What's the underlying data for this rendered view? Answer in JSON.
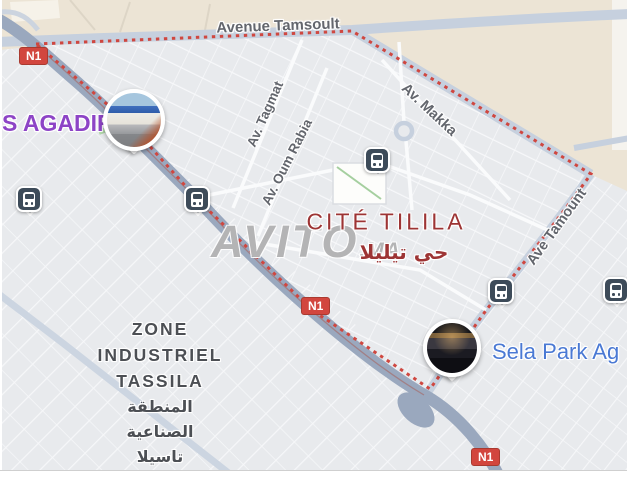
{
  "labels": {
    "tamsoult": "Avenue Tamsoult",
    "tagmat": "Av. Tagmat",
    "oum_rabia": "Av. Oum Rabia",
    "makka": "Av. Makka",
    "tamount": "Ave Tamount"
  },
  "places": {
    "agadir": "S AGADIR",
    "cite_tilila": "CITÉ TILILA",
    "cite_tilila_ar": "حي تيليلا",
    "sela_park": "Sela Park Ag",
    "zone_lines": [
      "ZONE",
      "INDUSTRIEL",
      "TASSILA"
    ],
    "zone_lines_ar": [
      "المنطقة",
      "الصناعية",
      "تاسيلا"
    ]
  },
  "badges": {
    "n1": "N1"
  },
  "watermark": {
    "name": "AVITO",
    "tld": ".MA"
  },
  "icons": {
    "bus_station": "bus-front-icon",
    "photo_marker_1": "storefront-photo",
    "photo_marker_2": "mall-night-photo"
  },
  "colors": {
    "boundary_red": "#cf4740",
    "route_badge_red": "#d2463e",
    "poi_purple": "#8d44c6",
    "poi_blue": "#4a79d4",
    "district_red": "#9d3434",
    "land_beige": "#ece4d5",
    "highway_gray_blue": "#9aa8be",
    "transit_icon_slate": "#3d4b59",
    "watermark_gray": "#8a8a8a"
  }
}
